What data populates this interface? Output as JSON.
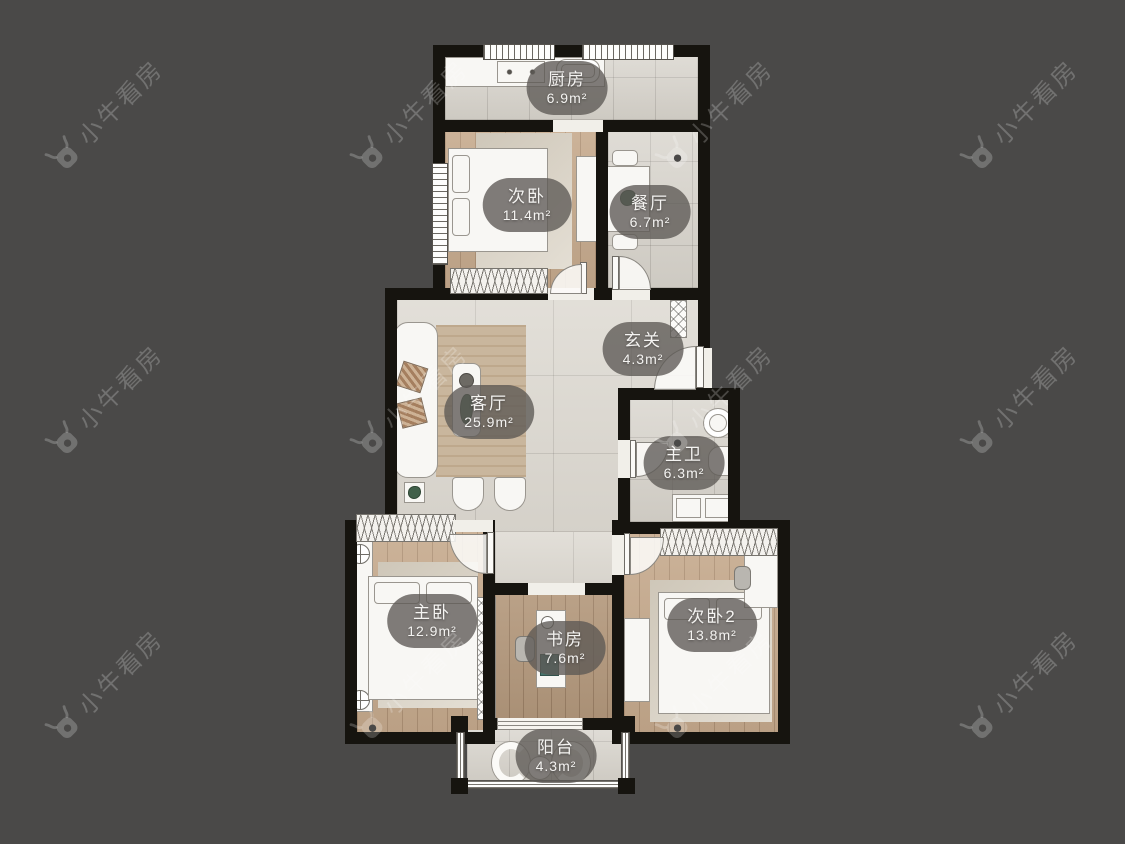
{
  "watermark": {
    "text": "小牛看房",
    "icon": "cow-logo-icon"
  },
  "rooms": [
    {
      "id": "kitchen",
      "name": "厨房",
      "area": "6.9m²"
    },
    {
      "id": "bedroom-2",
      "name": "次卧",
      "area": "11.4m²"
    },
    {
      "id": "dining",
      "name": "餐厅",
      "area": "6.7m²"
    },
    {
      "id": "entry",
      "name": "玄关",
      "area": "4.3m²"
    },
    {
      "id": "living",
      "name": "客厅",
      "area": "25.9m²"
    },
    {
      "id": "master-bath",
      "name": "主卫",
      "area": "6.3m²"
    },
    {
      "id": "master-bedroom",
      "name": "主卧",
      "area": "12.9m²"
    },
    {
      "id": "study",
      "name": "书房",
      "area": "7.6m²"
    },
    {
      "id": "bedroom-3",
      "name": "次卧2",
      "area": "13.8m²"
    },
    {
      "id": "balcony",
      "name": "阳台",
      "area": "4.3m²"
    }
  ],
  "colors": {
    "background": "#4a4948",
    "wall": "#16140f",
    "tile_small": "#d6d2ca",
    "tile_large": "#dcd8d0",
    "wood": "#c6aa8d",
    "wood_dark": "#b4997d",
    "rug_tan": "#c9b69d",
    "rug_light": "#ddd6c9",
    "furniture": "#f8f7f4",
    "label_bg": "rgba(92,89,85,0.78)",
    "label_text": "#f4f3f1",
    "watermark": "rgba(255,255,255,0.22)"
  }
}
